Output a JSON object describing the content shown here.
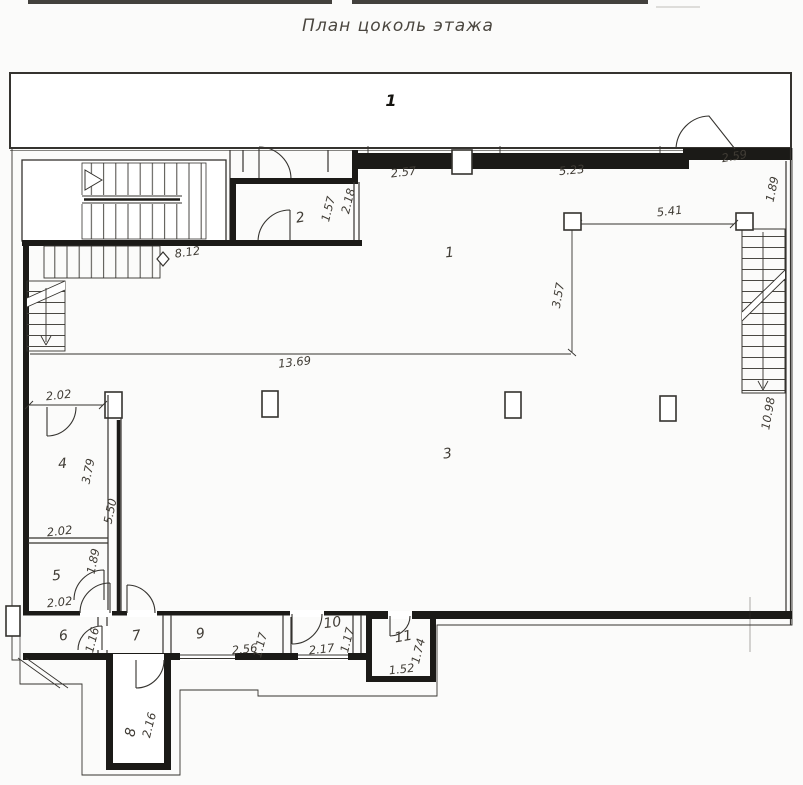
{
  "title": "План цоколь этажа",
  "colors": {
    "line": "#35332f",
    "thick": "#1b1a17",
    "text": "#403c35",
    "bg": "#fbfbfa",
    "hatch": "#4a4843"
  },
  "band": {
    "label": "1"
  },
  "rooms": {
    "r1": "1",
    "r2": "2",
    "r3": "3",
    "r4": "4",
    "r5": "5",
    "r6": "6",
    "r7": "7",
    "r8": "8",
    "r9": "9",
    "r10": "10",
    "r11": "11"
  },
  "dims": {
    "top_wall_left": "2.57",
    "top_wall_right": "5.23",
    "entry_door_top_right": "2.59",
    "right_upper": "1.89",
    "columns_span": "5.41",
    "column_drop": "3.57",
    "room2_width": "1.57",
    "room2_height": "2.18",
    "left_stair": "8.12",
    "hall_length": "13.69",
    "right_stair_height": "10.98",
    "room4_width_top": "2.02",
    "room4_height": "3.79",
    "partition_height": "5.50",
    "room4_width_bottom": "2.02",
    "room5_height": "1.89",
    "room5_width_bottom": "2.02",
    "room6_door": "1.16",
    "room9_width": "2.56",
    "room9_height": "1.17",
    "room10_width": "2.17",
    "room10_height": "1.17",
    "room11_height": "1.74",
    "room11_width": "1.52",
    "room8_height": "2.16"
  }
}
